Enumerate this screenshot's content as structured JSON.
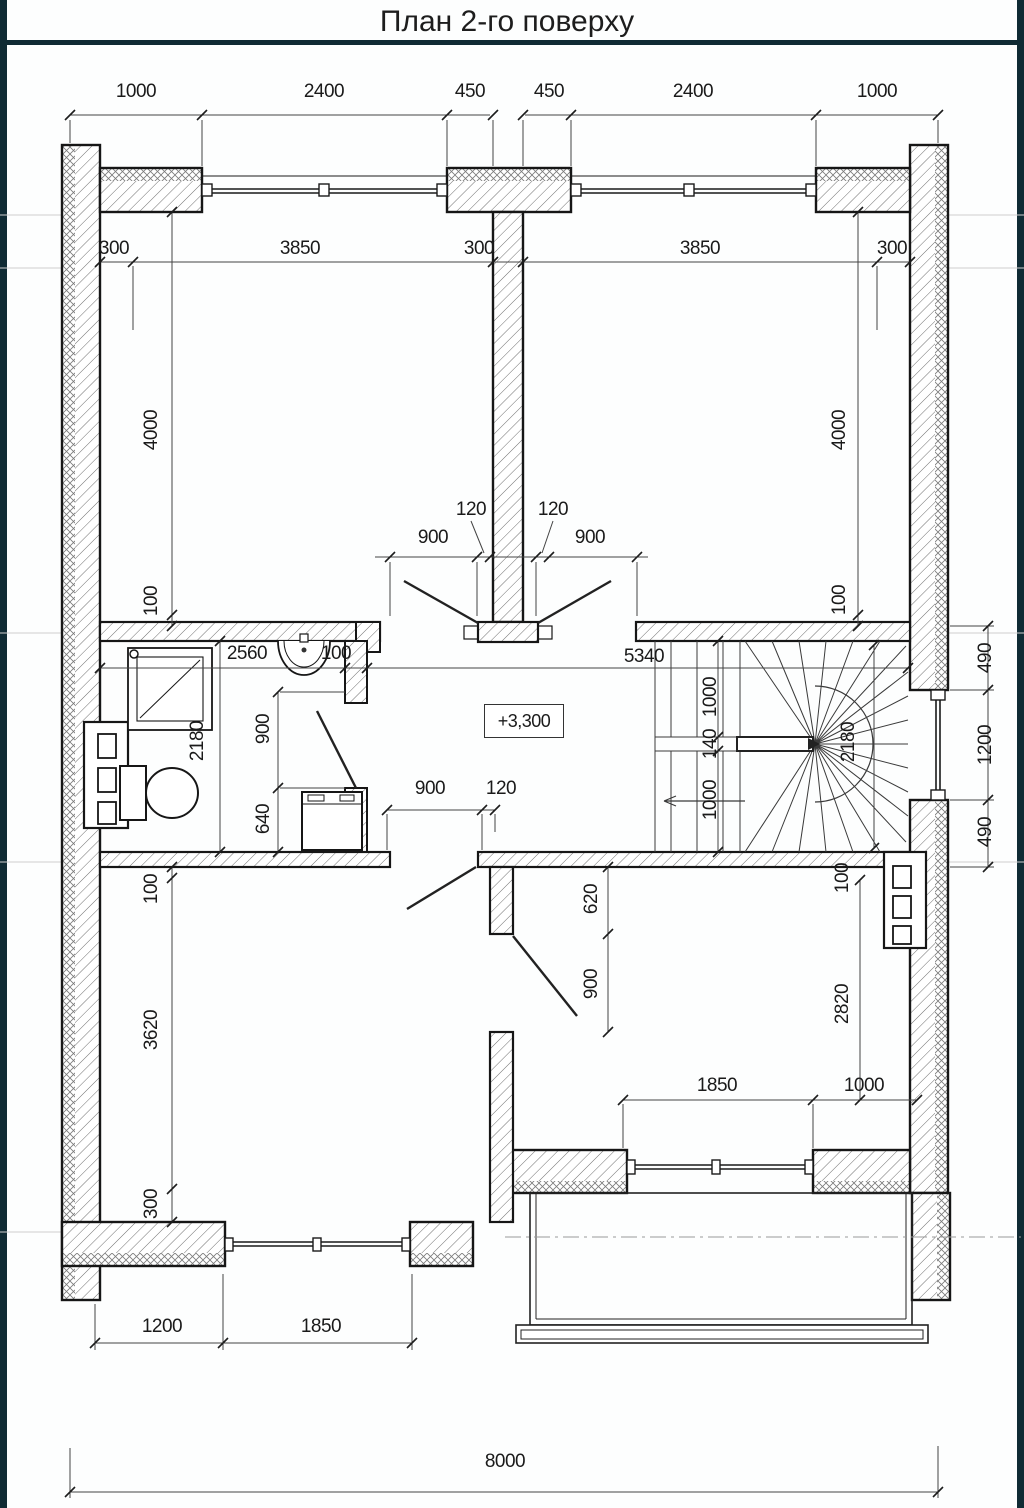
{
  "meta": {
    "title": "План 2-го поверху",
    "level_mark": "+3,300"
  },
  "colors": {
    "accent_bar": "#102b34",
    "ink": "#1a1a1a",
    "dim_line": "#444444",
    "faint": "#cfcfcf"
  },
  "dims": {
    "top": [
      "1000",
      "2400",
      "450",
      "450",
      "2400",
      "1000"
    ],
    "inner_top": [
      "300",
      "3850",
      "300",
      "3850",
      "300"
    ],
    "left_upper": [
      "4000",
      "100"
    ],
    "right_upper": [
      "4000",
      "100"
    ],
    "doors_top": [
      "120",
      "120",
      "900",
      "900"
    ],
    "corridor": [
      "2560",
      "100",
      "5340"
    ],
    "bath": [
      "2180",
      "900",
      "640"
    ],
    "stair": [
      "1000",
      "140",
      "1000",
      "2180"
    ],
    "right_outer": [
      "490",
      "1200",
      "490"
    ],
    "mid_lower": [
      "900",
      "120",
      "620",
      "900"
    ],
    "room_br": [
      "100",
      "2820",
      "1850",
      "1000"
    ],
    "left_lower": [
      "100",
      "3620",
      "300"
    ],
    "bottom_left": [
      "1200",
      "1850"
    ],
    "overall": [
      "8000"
    ]
  }
}
